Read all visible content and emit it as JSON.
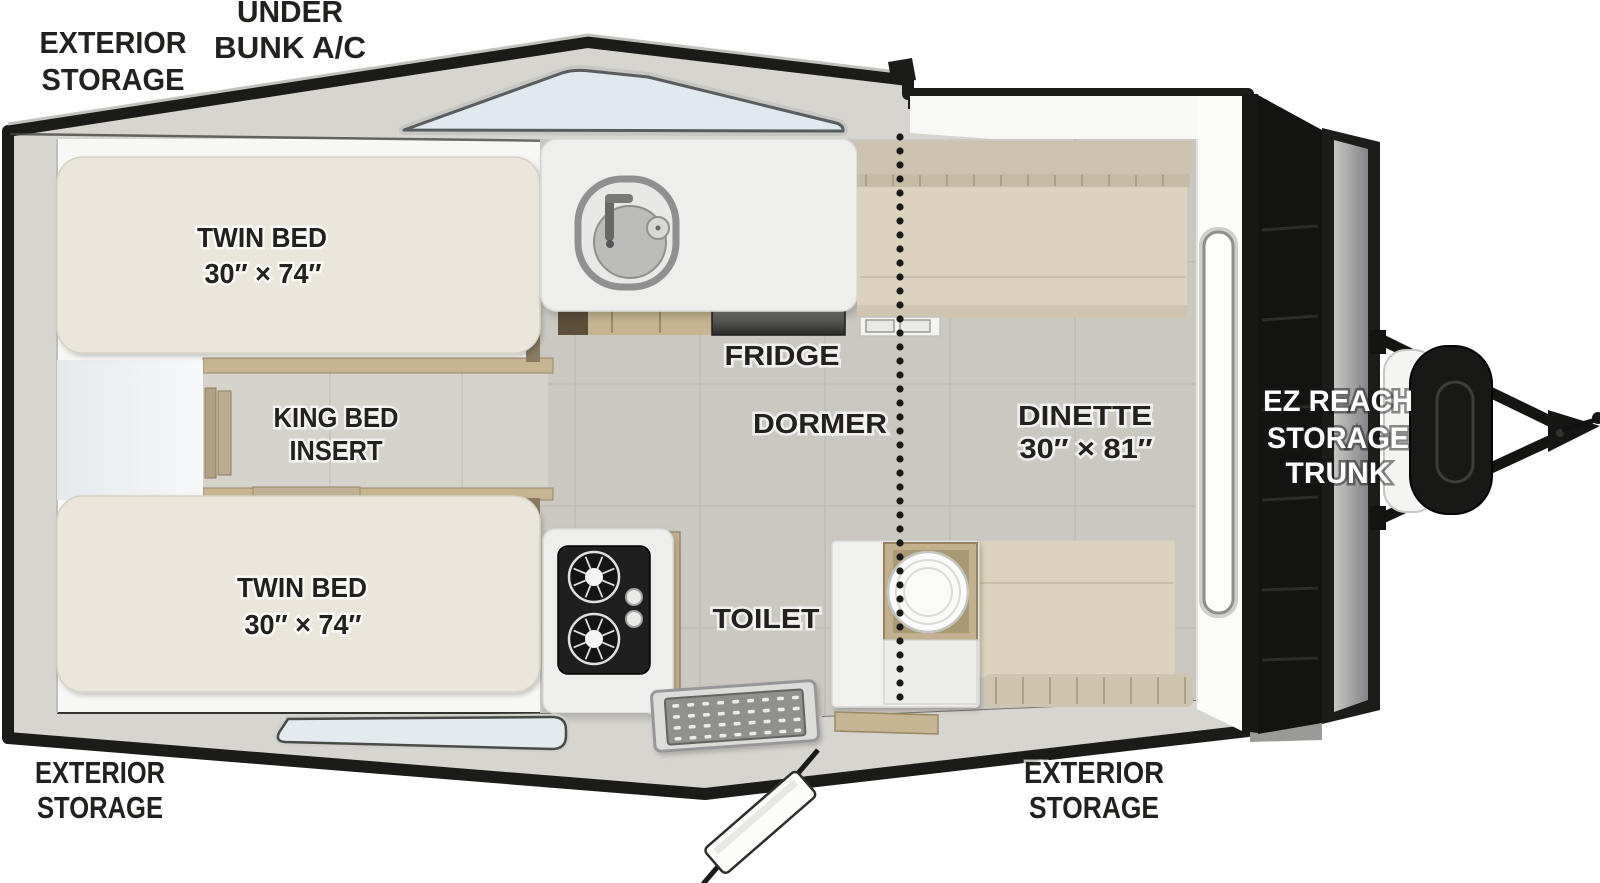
{
  "floorplan": {
    "labels": {
      "exterior_storage_top": {
        "l1": "EXTERIOR",
        "l2": "STORAGE"
      },
      "under_bunk_ac": {
        "l1": "UNDER",
        "l2": "BUNK A/C"
      },
      "twin_bed_top": {
        "l1": "TWIN BED",
        "l2": "30″ × 74″"
      },
      "king_bed_insert": {
        "l1": "KING BED",
        "l2": "INSERT"
      },
      "twin_bed_bottom": {
        "l1": "TWIN BED",
        "l2": "30″ × 74″"
      },
      "fridge": "FRIDGE",
      "dormer": "DORMER",
      "dinette": {
        "l1": "DINETTE",
        "l2": "30″ × 81″"
      },
      "toilet": "TOILET",
      "ez_reach_trunk": {
        "l1": "EZ REACH",
        "l2": "STORAGE",
        "l3": "TRUNK"
      },
      "exterior_storage_bottom_left": {
        "l1": "EXTERIOR",
        "l2": "STORAGE"
      },
      "exterior_storage_bottom_right": {
        "l1": "EXTERIOR",
        "l2": "STORAGE"
      }
    },
    "colors": {
      "body_outline": "#1b1b1a",
      "body_band": "#d7d5cf",
      "floor": "#cbc8c1",
      "mattress": "#eae6db",
      "cushion": "#dcd2bd",
      "wood": "#c6b492",
      "window_glass": "#dfe9ee",
      "trunk_black": "#131312",
      "label_text": "#22211f",
      "label_halo": "#ffffff"
    }
  }
}
